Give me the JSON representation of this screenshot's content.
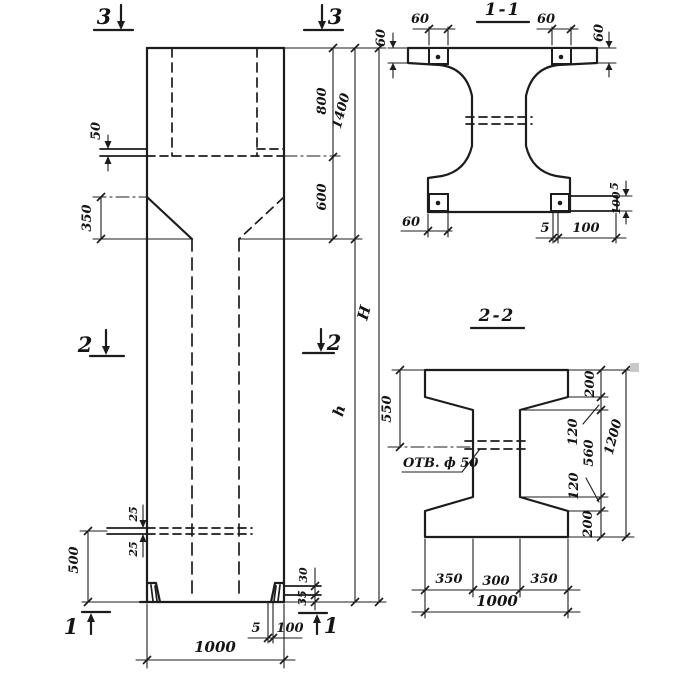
{
  "colors": {
    "ink": "#1c1c1c",
    "paper": "#ffffff",
    "artifact": "#c9c9c9"
  },
  "elevation": {
    "markers": {
      "top_left": "3",
      "top_right": "3",
      "mid_left": "2",
      "mid_right": "2",
      "bottom_left": "1",
      "bottom_right": "1"
    },
    "dims": {
      "console_plate": "50",
      "taper_height": "350",
      "cap_upper": "800",
      "cap_lower": "600",
      "cap_total": "1400",
      "total_height": "H",
      "shaft_height": "h",
      "lug_upper": "25",
      "lug_lower": "25",
      "lug_level": "500",
      "shoe_upper": "30",
      "shoe_lower": "35",
      "shoe_thk": "5",
      "shoe_len": "100",
      "width": "1000"
    }
  },
  "section11": {
    "title": "1-1",
    "dims": {
      "plate_tl": "60",
      "plate_tr": "60",
      "flange_left": "60",
      "flange_right": "60",
      "plate_bl": "60",
      "shoe_thk": "5",
      "shoe_len": "100",
      "side_thk": "5",
      "side_len": "100"
    }
  },
  "section22": {
    "title": "2-2",
    "hole_label": "ОТВ. ф 50",
    "dims": {
      "flange_depth": "550",
      "top_200": "200",
      "top_120": "120",
      "web_560": "560",
      "bot_120": "120",
      "bot_200": "200",
      "total_1200": "1200",
      "w_350l": "350",
      "w_300": "300",
      "w_350r": "350",
      "w_1000": "1000"
    }
  }
}
